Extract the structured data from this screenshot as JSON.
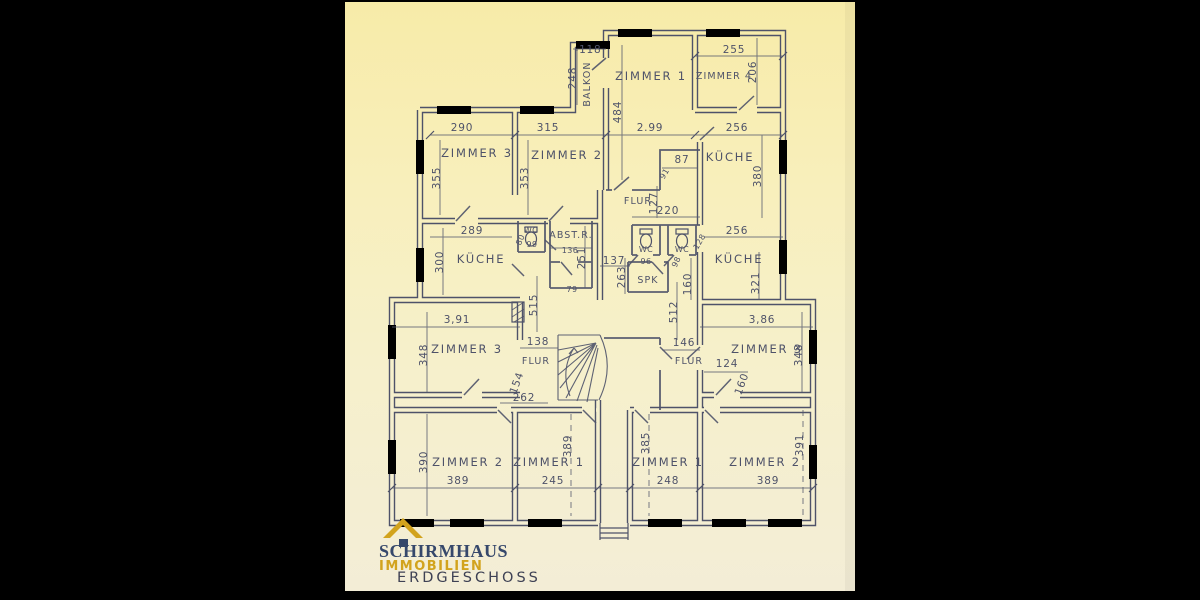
{
  "colors": {
    "backdrop": "#000000",
    "paper_top": "#f7eba8",
    "paper_bottom": "#f3edd7",
    "ink": "#4e5269",
    "brand_navy": "#36486b",
    "brand_gold": "#d2a31d"
  },
  "branding": {
    "company": "SCHIRMHAUS",
    "division": "IMMOBILIEN",
    "floor_label": "ERDGESCHOSS"
  },
  "plan": {
    "rooms": {
      "balkon": "BALKON",
      "z1_top": "ZIMMER 1",
      "z4_top": "ZIMMER 4",
      "kueche_top_right": "KÜCHE",
      "z3_upper_left": "ZIMMER 3",
      "z2_upper_left": "ZIMMER 2",
      "kueche_mid_left": "KÜCHE",
      "wc_left": "WC",
      "abstr": "ABST.R.",
      "wc_center_left": "WC",
      "wc_center_right": "WC",
      "spk": "SPK",
      "kueche_mid_right": "KÜCHE",
      "flur_top": "FLUR",
      "flur_lower_left": "FLUR",
      "flur_lower_right": "FLUR",
      "z3_lower_left": "ZIMMER 3",
      "z3_lower_right": "ZIMMER 3",
      "z2_bottom_left": "ZIMMER 2",
      "z1_bottom_left": "ZIMMER 1",
      "z1_bottom_right": "ZIMMER 1",
      "z2_bottom_right": "ZIMMER 2"
    },
    "dims": {
      "balkon_width": "-118",
      "balkon_depth": "248",
      "z4_width": "255",
      "z4_height": "206",
      "z1_height": "484",
      "chain_290": "290",
      "chain_315": "315",
      "chain_299": "2.99",
      "chain_256": "256",
      "z3ul_height": "355",
      "z2ul_height": "353",
      "nook_87": "87",
      "door_91": "91",
      "kueche_tr_height": "380",
      "flur_127": "127",
      "wc_chain_220": "220",
      "kueche_ml_width": "289",
      "kueche_ml_height": "300",
      "wc_left_99": "99",
      "wc_left_door": "80",
      "abstr_width": "136",
      "abstr_height": "251",
      "abstr_79": "79",
      "dim_137": "137",
      "wc_96": "96",
      "wc_98": "98",
      "wc_128": "128",
      "kueche_mr_width": "256",
      "kueche_mr_height": "321",
      "spk_263": "263",
      "mid_160": "160",
      "dim_515": "515",
      "dim_512": "512",
      "z3ll_width": "3,91",
      "z3ll_height": "348",
      "flur_ll_138": "138",
      "flur_ll_154": "154",
      "flur_ll_262": "262",
      "flur_lr_146": "146",
      "flur_lr_124": "124",
      "flur_lr_160": "160",
      "z3lr_width": "3,86",
      "z3lr_height": "348",
      "z2bl_height": "390",
      "z2bl_width": "389",
      "z1bl_width": "245",
      "z1bl_height": "389",
      "z1br_height": "385",
      "z1br_width": "248",
      "z2br_width": "389",
      "z2br_height": "391"
    }
  }
}
